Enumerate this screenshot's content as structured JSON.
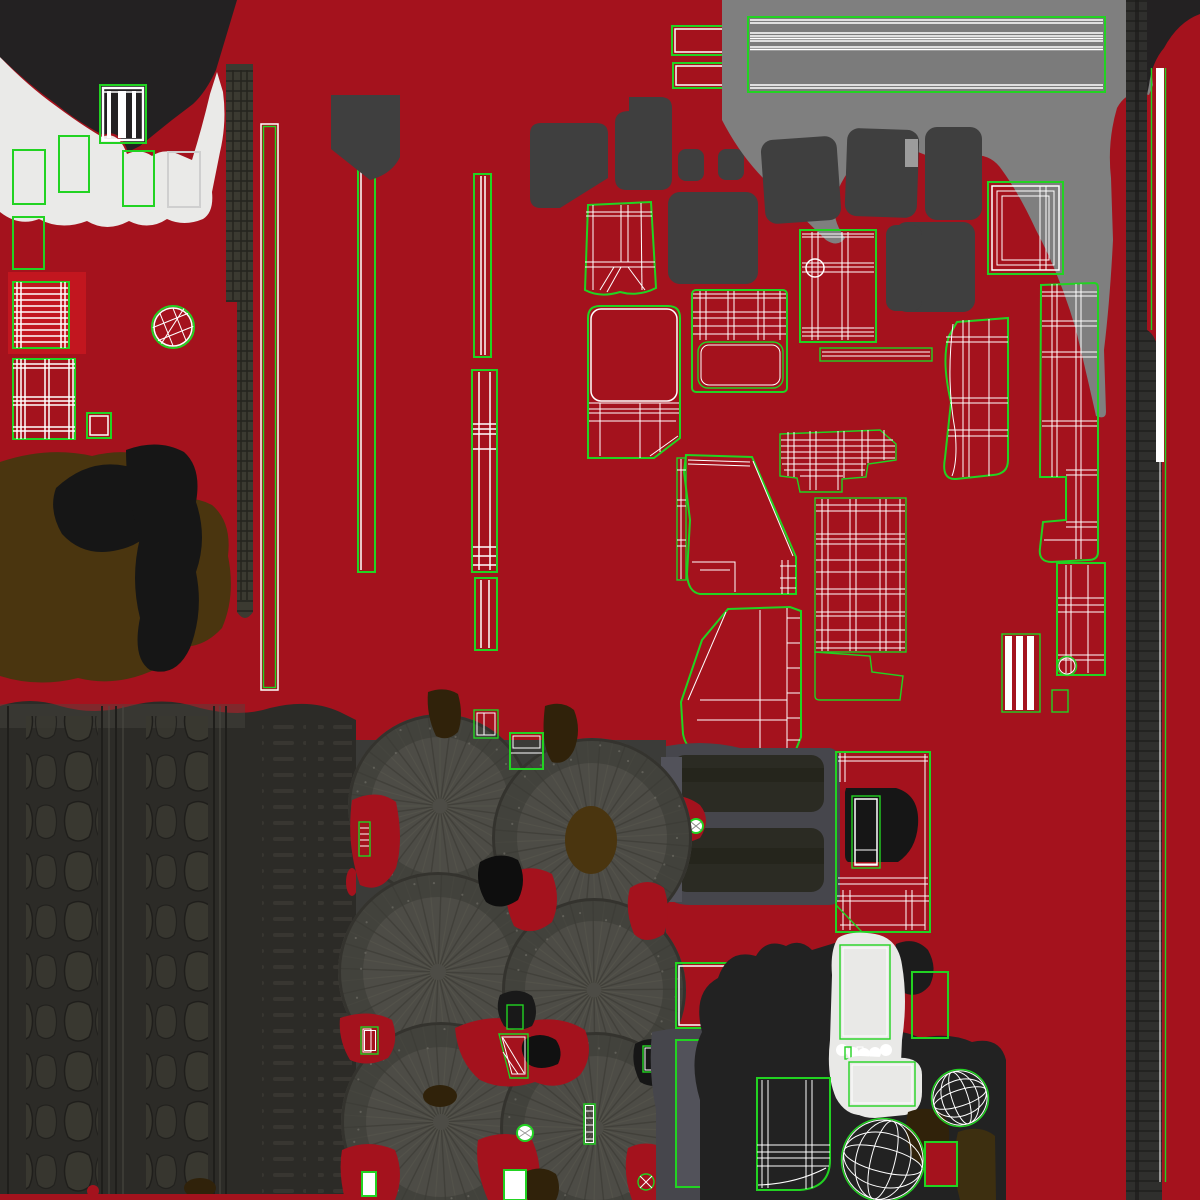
{
  "document": {
    "kind": "3d-texture-atlas-uv-map",
    "visible_text": "none",
    "canvas": {
      "width": 1200,
      "height": 1200
    }
  },
  "palette": {
    "red": "#A4121D",
    "redBright": "#C2161F",
    "green": "#22D322",
    "white": "#FFFFFF",
    "offWhite": "#EAEAE8",
    "paleGray": "#CFCFCF",
    "charcoal": "#232122",
    "seatGray": "#3F3F3F",
    "midGray": "#7F7F7F",
    "ribGray": "#7B7B7B",
    "lightTip": "#9C9C9C",
    "slate": "#46464C",
    "slateLight": "#52525A",
    "olive": "#3B3A31",
    "oliveDark": "#26251F",
    "treadBase": "#2C2B27",
    "treadBlock": "#393830",
    "treadDark": "#1F1E1B",
    "treadLight": "#4C4B44",
    "wheel": "#4D4C46",
    "wheelLight": "#5A594F",
    "wheelDark": "#3B3A34",
    "brown": "#4A350F",
    "brownDark": "#30220A",
    "blobBlack": "#161616",
    "cardWhite": "#E9E9E7",
    "boardTex": "#2B2B23"
  },
  "wheels": [
    {
      "cx": 440,
      "cy": 806,
      "r": 92
    },
    {
      "cx": 592,
      "cy": 838,
      "r": 100
    },
    {
      "cx": 438,
      "cy": 972,
      "r": 100
    },
    {
      "cx": 594,
      "cy": 990,
      "r": 92
    },
    {
      "cx": 441,
      "cy": 1122,
      "r": 100
    },
    {
      "cx": 596,
      "cy": 1128,
      "r": 96
    }
  ],
  "regions": [
    {
      "name": "topleft-fabric-region",
      "contents": "charcoal blob, white cloth patch, wheel-rim uv, green uv rectangles, grid and plaid uv tables, sphere gizmo uv"
    },
    {
      "name": "left-leather-region",
      "contents": "brown and black leather blobs, olive textured strip"
    },
    {
      "name": "center-strips",
      "contents": "long thin uv strips with green outlines and white seams"
    },
    {
      "name": "seat-cluster",
      "contents": "dark gray seat silhouettes and white wireframe seat uv shells"
    },
    {
      "name": "top-right-panel",
      "contents": "gray zone, ribbed sill panel uv, seat blobs, frame uv islands"
    },
    {
      "name": "right-edge-strips",
      "contents": "dark textured vertical strip, green and white vertical uv seams"
    },
    {
      "name": "tire-tread",
      "contents": "dark tread texture columns with blocks and sipes"
    },
    {
      "name": "tire-sidewalls",
      "contents": "six radial tire sidewall circles with red gaps and small uv bits"
    },
    {
      "name": "bottom-right-cluster",
      "contents": "white cards, black shapes, wireframe globes, console uv, red uv rectangles"
    }
  ]
}
